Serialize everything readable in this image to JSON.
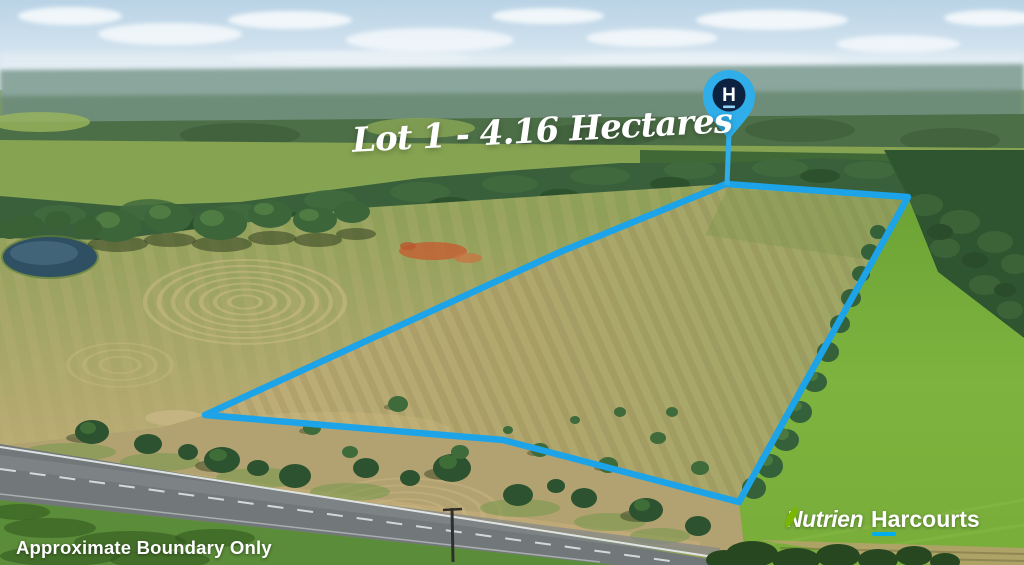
{
  "overlay": {
    "lot_label": "Lot 1 - 4.16 Hectares",
    "disclaimer": "Approximate Boundary Only",
    "pin": {
      "letter": "H"
    }
  },
  "branding": {
    "nutrien": "Nutrien",
    "harcourts": "Harcourts"
  },
  "colors": {
    "boundary_blue": "#1CA3E8",
    "pin_blue": "#2FAEEA",
    "pin_badge_navy": "#0D2240",
    "pin_letter_white": "#FFFFFF",
    "pin_underline_blue": "#8FD4F7",
    "nutrien_leaf_green": "#7AB800",
    "harcourts_underline_blue": "#00AEEF"
  }
}
